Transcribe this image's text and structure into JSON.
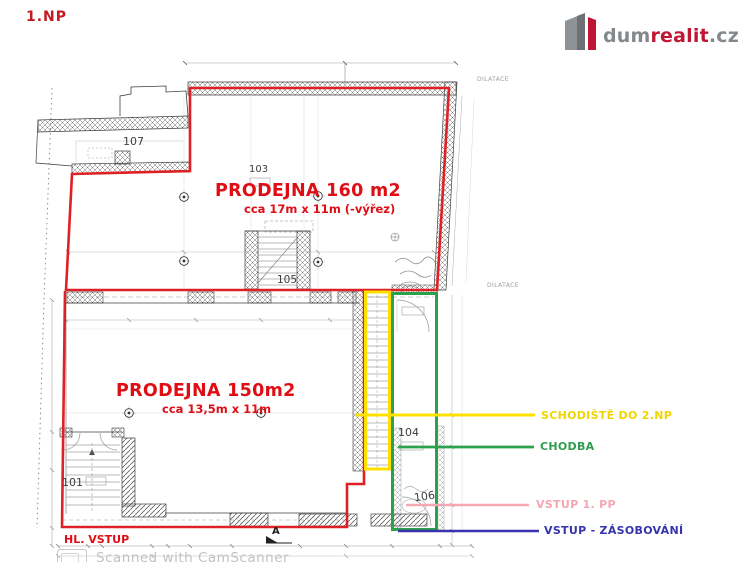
{
  "page": {
    "title": "1.NP",
    "watermark": "Scanned with CamScanner"
  },
  "logo": {
    "text_gray1": "dum",
    "text_red": "realit",
    "text_gray2": ".cz"
  },
  "areas": {
    "upper": {
      "name": "PRODEJNA 160 m2",
      "dims": "cca 17m x 11m (-výřez)"
    },
    "lower": {
      "name": "PRODEJNA 150m2",
      "dims": "cca 13,5m x 11m"
    }
  },
  "rooms": {
    "r101": "101",
    "r103": "103",
    "r104": "104",
    "r105": "105",
    "r106": "106",
    "r107": "107"
  },
  "callouts": {
    "staircase": {
      "label": "SCHODIŠTĚ DO 2.NP",
      "color": "#f0d500"
    },
    "corridor": {
      "label": "CHODBA",
      "color": "#2e9e4e"
    },
    "entrance_1pp": {
      "label": "VSTUP 1. PP",
      "color": "#f4a6b4"
    },
    "entrance_supply": {
      "label": "VSTUP - ZÁSOBOVÁNÍ",
      "color": "#3734ad"
    }
  },
  "labels": {
    "main_entrance": "HL. VSTUP",
    "section_marker": "A",
    "expansion_joint": "DILATACE"
  },
  "plan_colors": {
    "outline_red": "#de2125",
    "highlight_yellow": "#ffdf00",
    "highlight_green": "#2aa14a",
    "callout_pink": "#f5a7b4",
    "callout_blue": "#3a33ae"
  }
}
